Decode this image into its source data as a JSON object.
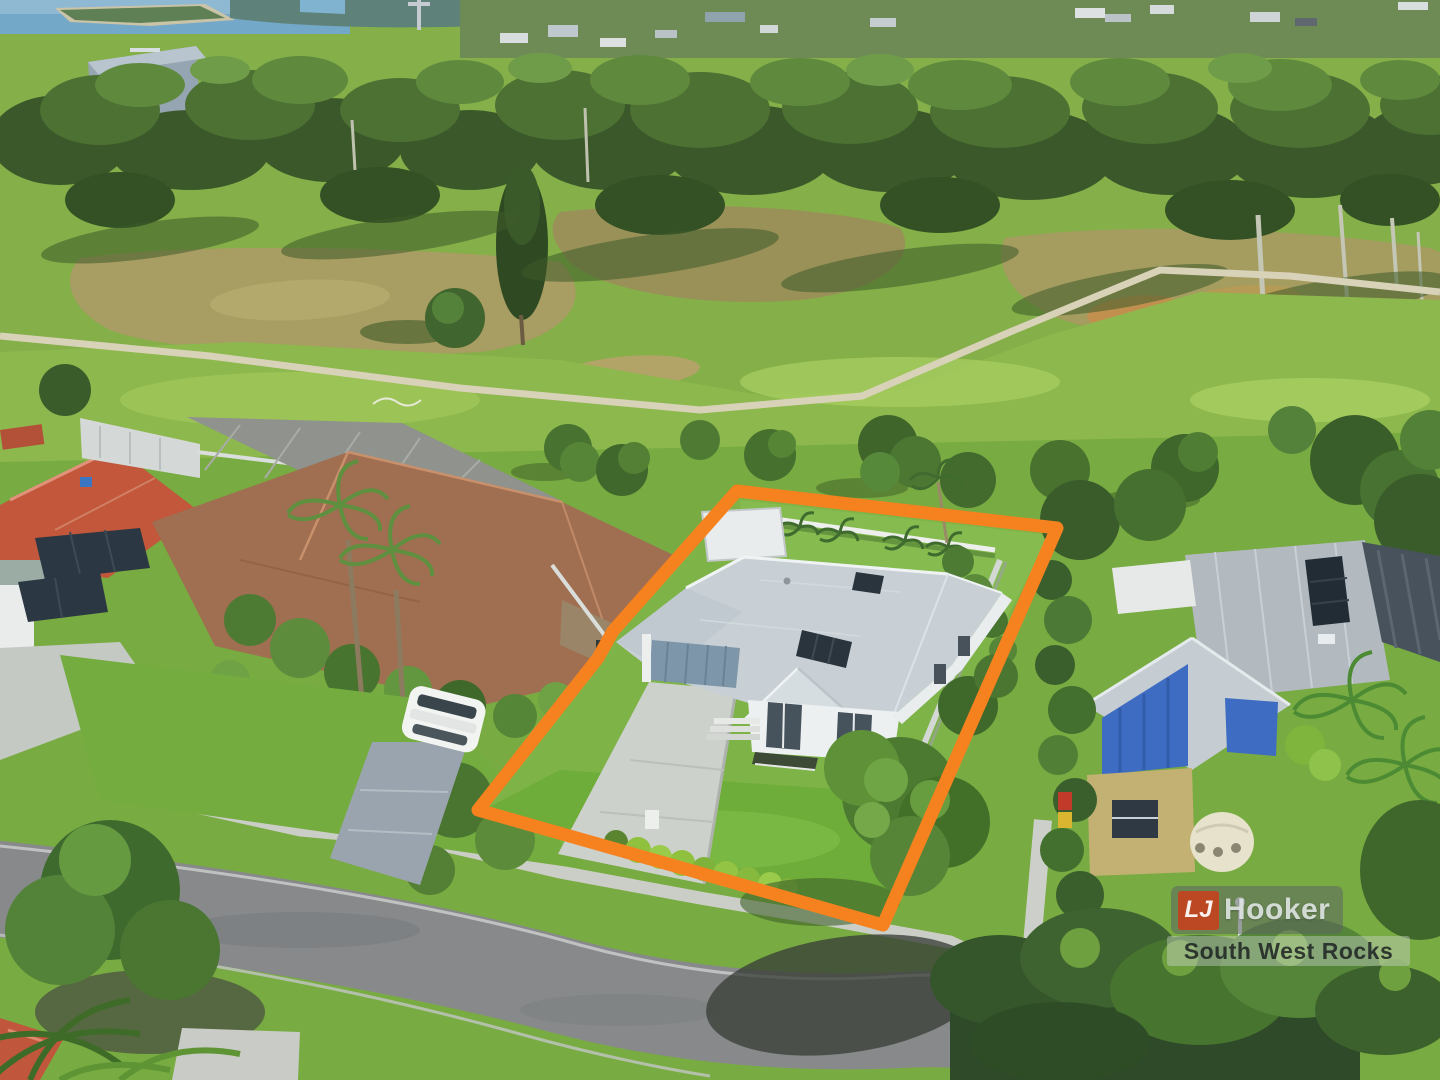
{
  "photo": {
    "kind": "aerial-drone-photo",
    "subject": "single-storey coastal home on green lawn block outlined for sale",
    "boundary_color": "#F5821F"
  },
  "watermark": {
    "brand_initials": "LJ",
    "brand_name": "Hooker",
    "office_name": "South West Rocks",
    "tile_color": "#C6401C"
  }
}
